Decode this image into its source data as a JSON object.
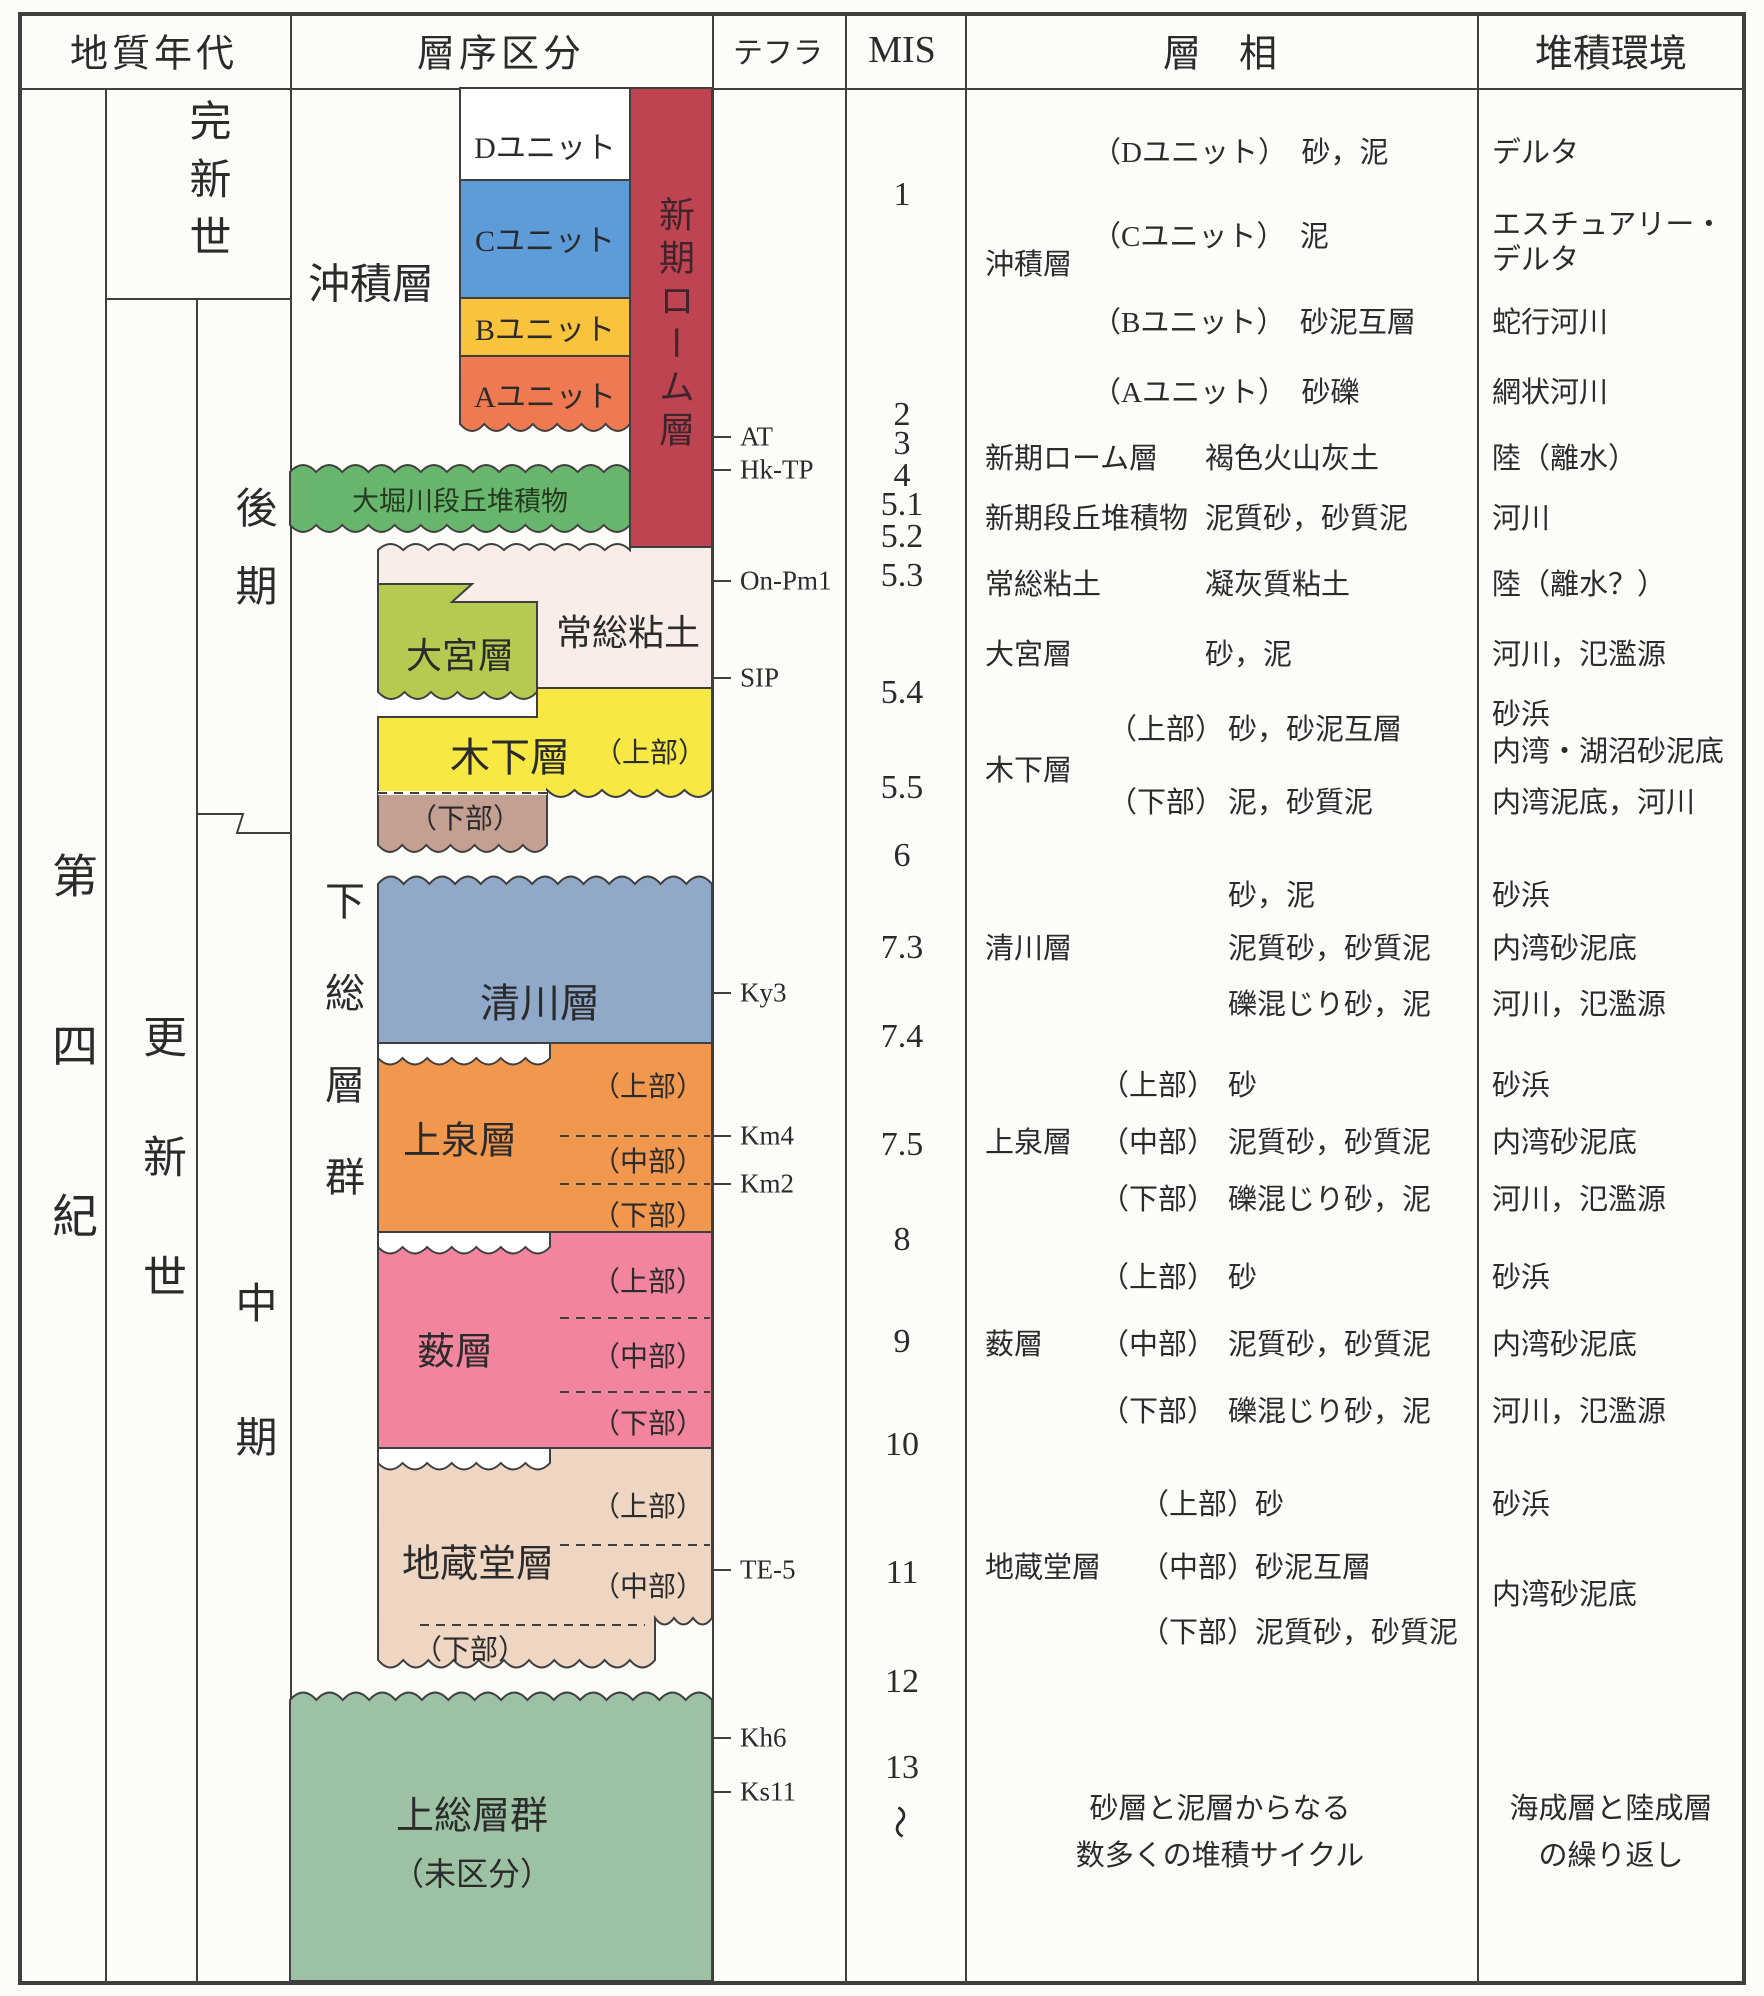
{
  "header": {
    "era": "地質年代",
    "strat": "層序区分",
    "tephra": "テフラ",
    "mis": "MIS",
    "facies": "層　相",
    "env": "堆積環境"
  },
  "era": {
    "quaternary": "第四紀",
    "holocene": "完新世",
    "pleistocene": "更新世",
    "late": "後期",
    "middle": "中期"
  },
  "strat": {
    "chuseki": "沖積層",
    "unit_d": "Dユニット",
    "unit_c": "Cユニット",
    "unit_b": "Bユニット",
    "unit_a": "Aユニット",
    "rohm": "新期ローム層",
    "ohori": "大堀川段丘堆積物",
    "joso": "常総粘土",
    "omiya": "大宮層",
    "kinoshita": "木下層",
    "kiyokawa": "清川層",
    "kamiizumi": "上泉層",
    "yabu": "薮層",
    "jizodo": "地蔵堂層",
    "shimousa": "下総層群",
    "kazusa": "上総層群",
    "kazusa_note": "（未区分）",
    "upper": "（上部）",
    "middle": "（中部）",
    "lower": "（下部）"
  },
  "tephra": [
    "AT",
    "Hk-TP",
    "On-Pm1",
    "SIP",
    "Ky3",
    "Km4",
    "Km2",
    "TE-5",
    "Kh6",
    "Ks11"
  ],
  "mis": [
    "1",
    "2",
    "3",
    "4",
    "5.1",
    "5.2",
    "5.3",
    "5.4",
    "5.5",
    "6",
    "7.3",
    "7.4",
    "7.5",
    "8",
    "9",
    "10",
    "11",
    "12",
    "13",
    "〜"
  ],
  "rows": {
    "r1": {
      "name": "沖積層",
      "f_d": "（Dユニット）　砂，泥",
      "e_d": "デルタ",
      "f_c": "（Cユニット）　泥",
      "e_c1": "エスチュアリー・",
      "e_c2": "デルタ",
      "f_b": "（Bユニット）　砂泥互層",
      "e_b": "蛇行河川",
      "f_a": "（Aユニット）　砂礫",
      "e_a": "網状河川"
    },
    "r2": {
      "name": "新期ローム層",
      "f": "褐色火山灰土",
      "e": "陸（離水）"
    },
    "r3": {
      "name": "新期段丘堆積物",
      "f": "泥質砂，砂質泥",
      "e": "河川"
    },
    "r4": {
      "name": "常総粘土",
      "f": "凝灰質粘土",
      "e": "陸（離水？）"
    },
    "r5": {
      "name": "大宮層",
      "f": "砂，泥",
      "e": "河川，氾濫源"
    },
    "r6": {
      "name": "木下層",
      "u": "（上部）",
      "u_f": "砂，砂泥互層",
      "u_e1": "砂浜",
      "u_e2": "内湾・湖沼砂泥底",
      "l": "（下部）",
      "l_f": "泥，砂質泥",
      "l_e": "内湾泥底，河川"
    },
    "r7": {
      "name": "清川層",
      "f1": "砂，泥",
      "e1": "砂浜",
      "f2": "泥質砂，砂質泥",
      "e2": "内湾砂泥底",
      "f3": "礫混じり砂，泥",
      "e3": "河川，氾濫源"
    },
    "r8": {
      "name": "上泉層",
      "u": "（上部）",
      "u_f": "砂",
      "u_e": "砂浜",
      "m": "（中部）",
      "m_f": "泥質砂，砂質泥",
      "m_e": "内湾砂泥底",
      "l": "（下部）",
      "l_f": "礫混じり砂，泥",
      "l_e": "河川，氾濫源"
    },
    "r9": {
      "name": "薮層",
      "u": "（上部）",
      "u_f": "砂",
      "u_e": "砂浜",
      "m": "（中部）",
      "m_f": "泥質砂，砂質泥",
      "m_e": "内湾砂泥底",
      "l": "（下部）",
      "l_f": "礫混じり砂，泥",
      "l_e": "河川，氾濫源"
    },
    "r10": {
      "name": "地蔵堂層",
      "u": "（上部）",
      "u_f": "砂",
      "u_e": "砂浜",
      "m": "（中部）",
      "m_f": "砂泥互層",
      "l": "（下部）",
      "l_f": "泥質砂，砂質泥",
      "e": "内湾砂泥底"
    },
    "r11": {
      "f1": "砂層と泥層からなる",
      "f2": "数多くの堆積サイクル",
      "e1": "海成層と陸成層",
      "e2": "の繰り返し"
    }
  },
  "colors": {
    "line": "#3f3f3f",
    "white": "#ffffff",
    "c_unit": "#5d9cd8",
    "b_unit": "#f9c33c",
    "a_unit": "#ef7a52",
    "rohm": "#bf4452",
    "ohori": "#68b56e",
    "joso": "#f8ede8",
    "omiya": "#b5ca50",
    "kinoshita": "#f7e843",
    "kinoshita_lower": "#c4a093",
    "kiyokawa": "#90a9c8",
    "kamiizumi": "#f1974e",
    "yabu": "#f2849e",
    "jizodo": "#eed6c2",
    "kazusa": "#9dc2a3"
  }
}
